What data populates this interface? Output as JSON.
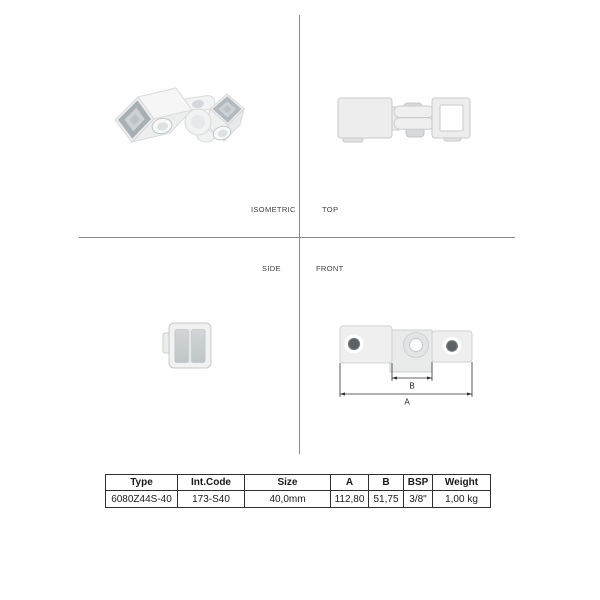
{
  "drawing": {
    "view_labels": {
      "isometric": "ISOMETRIC",
      "top": "TOP",
      "side": "SIDE",
      "front": "FRONT"
    },
    "dimension_labels": {
      "a": "A",
      "b": "B"
    }
  },
  "table": {
    "headers": [
      "Type",
      "Int.Code",
      "Size",
      "A",
      "B",
      "BSP",
      "Weight"
    ],
    "row": [
      "6080Z44S-40",
      "173-S40",
      "40,0mm",
      "112,80",
      "51,75",
      "3/8\"",
      "1,00 kg"
    ]
  },
  "colors": {
    "crosshair_line": "#8a8a8a",
    "dimension_line": "#333333",
    "table_border": "#2f2f2f",
    "part_body_light": "#f0f1f1",
    "part_body_mid": "#e6e8e8",
    "part_inner_dark": "#aeb4b8",
    "hole_dark": "#5d6163"
  }
}
